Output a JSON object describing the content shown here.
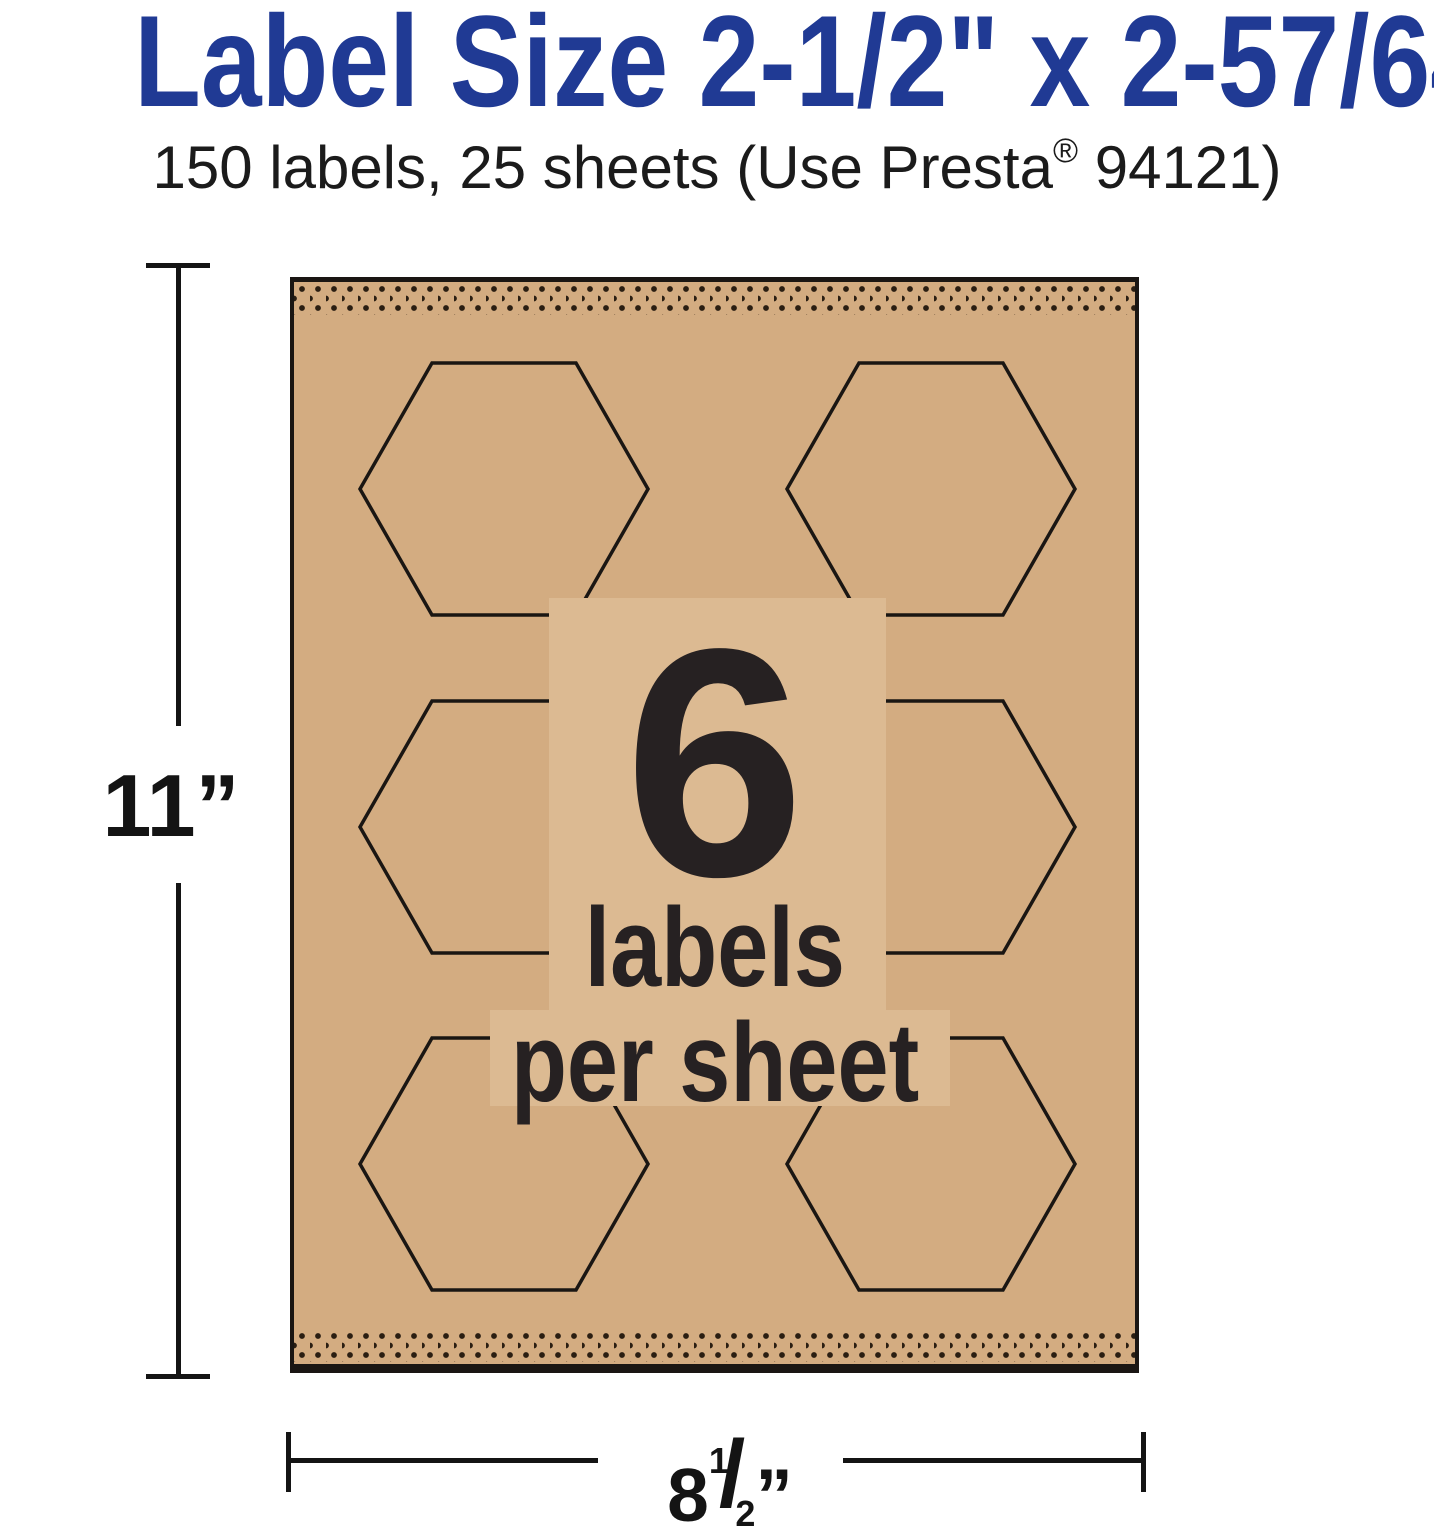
{
  "title": "Label Size 2-1/2\" x 2-57/64\"",
  "subtitle": {
    "before_reg": "150 labels, 25 sheets (Use Presta",
    "reg_mark": "®",
    "after_reg": " 94121)"
  },
  "sheet_graphic": {
    "count": "6",
    "count_caption_line1": "labels",
    "count_caption_line2": "per sheet",
    "hexagon_rows": 3,
    "hexagon_columns": 2
  },
  "dimension_annotations": {
    "height": "11”",
    "width_integer": "8",
    "width_numerator": "1",
    "width_slash": "/",
    "width_denominator": "2",
    "width_unit_mark": "”"
  },
  "colors": {
    "title_blue": "#203a94",
    "kraft_tan": "#d3ac81",
    "kraft_highlight": "#dcba92",
    "ink_black": "#262122",
    "line_black": "#1a1613"
  }
}
